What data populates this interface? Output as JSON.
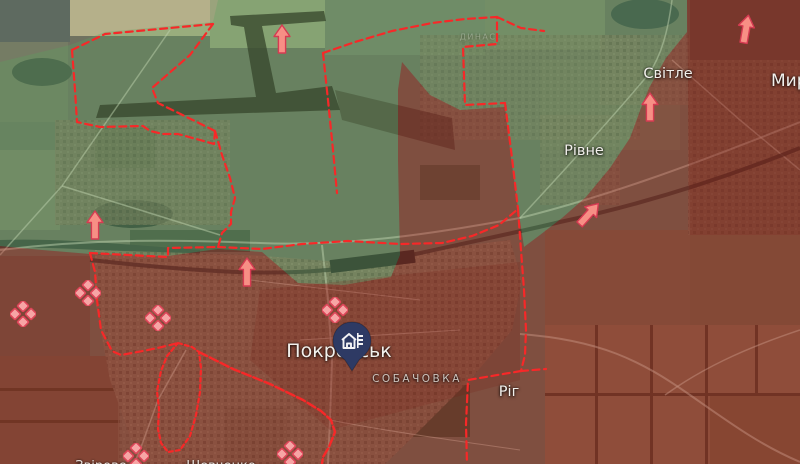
{
  "map_title": "Frontline map around Pokrovsk",
  "colors": {
    "frontline_red": "#f72828",
    "occupied_overlay": "rgba(150,32,22,0.42)",
    "contested_green_overlay": "rgba(90,165,95,0.30)",
    "clash_marker_pink": "#f7a5a5",
    "clash_marker_outline": "#dd4558",
    "advance_arrow_pink": "#f78f85",
    "advance_arrow_outline": "#d63b52",
    "city_pin_navy": "#2e3a64"
  },
  "labels": [
    {
      "id": "pokrovsk",
      "text": "Покровськ",
      "x": 339,
      "y": 351,
      "kind": "city"
    },
    {
      "id": "sobachovka",
      "text": "СОБАЧОВКА",
      "x": 417,
      "y": 379,
      "kind": "district"
    },
    {
      "id": "rivne",
      "text": "Рівне",
      "x": 584,
      "y": 151,
      "kind": "town"
    },
    {
      "id": "svitle",
      "text": "Світле",
      "x": 668,
      "y": 74,
      "kind": "town"
    },
    {
      "id": "myrnohrad",
      "text": "Мирноград",
      "x": 771,
      "y": 81,
      "kind": "city-clipped-right"
    },
    {
      "id": "rih",
      "text": "Ріг",
      "x": 509,
      "y": 392,
      "kind": "town"
    },
    {
      "id": "district-n",
      "text": "ДИНАС",
      "x": 478,
      "y": 37,
      "kind": "district-faint"
    },
    {
      "id": "zvirove",
      "text": "Звірове",
      "x": 101,
      "y": 459,
      "kind": "town-clipped-bottom"
    },
    {
      "id": "shevchenko",
      "text": "Шевченко",
      "x": 221,
      "y": 459,
      "kind": "town-clipped-bottom"
    }
  ],
  "markers": {
    "city_pin": {
      "id": "pokrovsk-city-pin",
      "icon": "city-buildings-icon",
      "x": 330,
      "y": 320
    },
    "clash_diamonds": [
      {
        "x": 10,
        "y": 301
      },
      {
        "x": 75,
        "y": 280
      },
      {
        "x": 145,
        "y": 305
      },
      {
        "x": 123,
        "y": 443
      },
      {
        "x": 277,
        "y": 441
      },
      {
        "x": 322,
        "y": 297
      }
    ],
    "advance_arrows": [
      {
        "x": 273,
        "y": 24,
        "angle": 0
      },
      {
        "x": 737,
        "y": 14,
        "angle": 10
      },
      {
        "x": 641,
        "y": 92,
        "angle": 0
      },
      {
        "x": 580,
        "y": 199,
        "angle": 42
      },
      {
        "x": 86,
        "y": 210,
        "angle": 0
      },
      {
        "x": 238,
        "y": 257,
        "angle": 0
      }
    ]
  }
}
